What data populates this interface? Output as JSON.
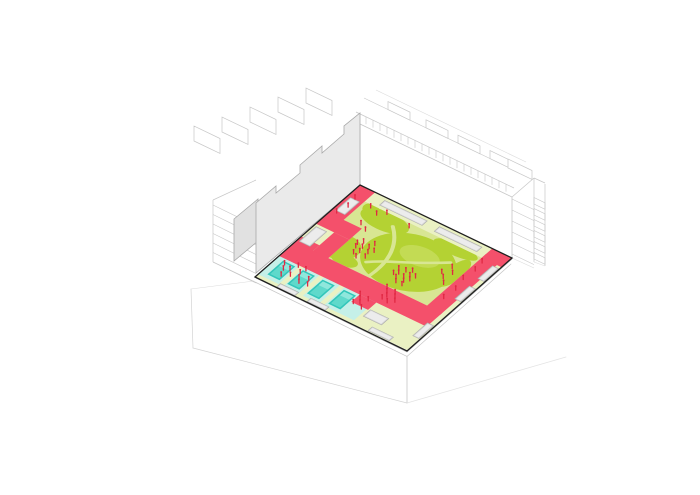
{
  "scene": {
    "kind": "axonometric-architecture-diagram",
    "elements": [
      "perimeter-buildings-wireframe",
      "section-cut-wall",
      "courtyard-landscape",
      "pool-deck",
      "people-markers"
    ]
  },
  "colors": {
    "background": "#FFFFFF",
    "outline_dark": "#1F1F1F",
    "wireframe": "#C7C7C7",
    "wireframe_faint": "#DCDCDC",
    "wall_face": "#EAEAEA",
    "wall_side": "#E1E1E1",
    "wall_stroke": "#A8A8A8",
    "facade_white": "#FFFFFF",
    "facade_stroke": "#C6C6C6",
    "border_pale": "#EAF1C3",
    "lawn_path": "#D8E693",
    "lawn_green": "#B4D233",
    "lawn_light": "#C5DD5A",
    "path_pink": "#F4506B",
    "water_deck": "#C5F0E8",
    "pool_rim": "#33C6BA",
    "pool_water": "#5FD9CB",
    "pool_shallow": "#8FE7DC",
    "planter_fill": "#D6D6D6",
    "planter_top": "#ECECEC",
    "planter_stroke": "#A9A9A9",
    "people_red": "#E02843",
    "ground_line": "#D3D3D3",
    "slab_edge": "#ABABAB"
  },
  "courtyard": {
    "corners_screen": {
      "north": [
        360,
        185
      ],
      "east": [
        512,
        258
      ],
      "south": [
        407,
        351
      ],
      "west": [
        255,
        277
      ]
    },
    "plan_matrix": [
      1.52,
      0.73,
      -1.05,
      0.92,
      360,
      185
    ],
    "pink_paths": [
      [
        0,
        0,
        10,
        32
      ],
      [
        0,
        30,
        22,
        12
      ],
      [
        12,
        42,
        10,
        22
      ],
      [
        0,
        56,
        12,
        21
      ],
      [
        0,
        62,
        97,
        15
      ],
      [
        53,
        77,
        11,
        8
      ],
      [
        87,
        6,
        10,
        58
      ],
      [
        87,
        0,
        13,
        10
      ]
    ],
    "lawn_polygon": "10,10 87,10 87,62 22,62 22,30 10,30",
    "mounds": [
      [
        58,
        38,
        27,
        24
      ],
      [
        22,
        50,
        11,
        11
      ],
      [
        28,
        17,
        15,
        8
      ],
      [
        16,
        13,
        4.5,
        4.5
      ],
      [
        72,
        13,
        14,
        5
      ],
      [
        83,
        30,
        5,
        14
      ],
      [
        30,
        58,
        8,
        5
      ]
    ],
    "mound_light": [
      60,
      30,
      12,
      8
    ],
    "lawn_trails": [
      "M 40,52 C 50,42 58,40 76,24",
      "M 34,18 C 44,28 50,42 48,60"
    ],
    "water_deck": [
      0,
      76,
      63,
      21
    ],
    "deck_strips": [
      [
        13.5,
        76,
        3,
        21
      ],
      [
        26.5,
        76,
        3,
        21
      ],
      [
        40,
        76,
        3,
        21
      ]
    ],
    "pools": [
      [
        4,
        79,
        8,
        15
      ],
      [
        17,
        79,
        8,
        15
      ],
      [
        30,
        79,
        8,
        15
      ],
      [
        44,
        79,
        8,
        15
      ]
    ],
    "planters": [
      [
        18,
        2.5,
        28,
        5
      ],
      [
        54,
        2.5,
        28,
        5
      ],
      [
        1.5,
        44,
        7,
        16
      ],
      [
        2,
        12,
        6,
        14
      ],
      [
        95.5,
        12,
        4,
        14
      ],
      [
        95.5,
        34,
        4,
        14
      ],
      [
        95.5,
        74,
        4,
        14
      ],
      [
        14,
        96,
        12,
        3.7
      ],
      [
        34,
        96,
        12,
        3.7
      ],
      [
        74,
        95.5,
        14,
        4
      ],
      [
        65,
        84,
        12,
        7
      ]
    ],
    "people": [
      [
        30,
        40
      ],
      [
        32,
        44
      ],
      [
        35,
        42
      ],
      [
        37,
        46
      ],
      [
        33,
        48
      ],
      [
        29,
        46
      ],
      [
        36,
        38
      ],
      [
        39,
        43
      ],
      [
        31,
        51
      ],
      [
        34,
        53
      ],
      [
        38,
        50
      ],
      [
        28,
        43
      ],
      [
        58,
        47
      ],
      [
        60,
        50
      ],
      [
        62,
        46
      ],
      [
        64,
        51
      ],
      [
        66,
        48
      ],
      [
        61,
        54
      ],
      [
        63,
        57
      ],
      [
        66,
        54
      ],
      [
        68,
        51
      ],
      [
        58,
        52
      ],
      [
        65,
        44
      ],
      [
        69,
        47
      ],
      [
        67,
        57
      ],
      [
        62,
        64
      ],
      [
        64,
        67
      ],
      [
        66,
        70
      ],
      [
        68,
        65
      ],
      [
        70,
        68
      ],
      [
        72,
        71
      ],
      [
        65,
        73
      ],
      [
        69,
        74
      ],
      [
        16,
        13
      ],
      [
        22,
        16
      ],
      [
        26,
        12
      ],
      [
        20,
        28
      ],
      [
        25,
        31
      ],
      [
        42,
        14
      ],
      [
        5,
        12
      ],
      [
        6,
        20
      ],
      [
        4,
        28
      ],
      [
        80,
        28
      ],
      [
        83,
        32
      ],
      [
        81,
        38
      ],
      [
        84,
        42
      ],
      [
        78,
        35
      ],
      [
        90,
        14
      ],
      [
        91,
        22
      ],
      [
        90,
        32
      ],
      [
        92,
        42
      ],
      [
        91,
        52
      ],
      [
        7,
        82
      ],
      [
        9,
        86
      ],
      [
        12,
        84
      ],
      [
        15,
        88
      ],
      [
        18,
        83
      ],
      [
        20,
        87
      ],
      [
        22,
        90
      ],
      [
        11,
        91
      ],
      [
        25,
        85
      ],
      [
        27,
        89
      ],
      [
        19,
        79
      ],
      [
        14,
        79
      ],
      [
        54,
        78
      ],
      [
        56,
        81
      ],
      [
        58,
        84
      ],
      [
        60,
        79
      ],
      [
        55,
        86
      ],
      [
        61,
        87
      ]
    ]
  },
  "buildings": {
    "northeast_slab": {
      "facade_points": "360,124 512,197 512,258 360,185",
      "balustrade_line": [
        356,
        112,
        514,
        188
      ],
      "roof_back_line": [
        364,
        98,
        520,
        173
      ],
      "roof_far_line": [
        376,
        90,
        526,
        162
      ],
      "roof_boxes_x": [
        388,
        426,
        458,
        490
      ]
    },
    "east_wing": {
      "roof_link": [
        512,
        197,
        534,
        178
      ],
      "inner_vertical": [
        534,
        178,
        534,
        262
      ],
      "outer_vertical": [
        545,
        184,
        545,
        266
      ],
      "roof_edge": [
        534,
        178,
        545,
        183
      ],
      "base_line1": [
        512,
        258,
        534,
        268
      ],
      "base_line2": [
        534,
        262,
        545,
        266
      ],
      "floors": 6
    },
    "northwest_wall": {
      "main_points": "360,113 360,185 256,273 256,203 276,186 276,193 300,173 300,165 322,146 322,153 344,134 344,126",
      "side_points": "234,219 258,199 258,241 234,261",
      "roof_boxes": [
        [
          194,
          141
        ],
        [
          222,
          132
        ],
        [
          250,
          122
        ],
        [
          278,
          112
        ],
        [
          306,
          103
        ]
      ],
      "low_wing_vertical": [
        213,
        200,
        213,
        262
      ],
      "low_wing_top": [
        213,
        200,
        256,
        180
      ],
      "low_wing_base": [
        213,
        262,
        257,
        283
      ],
      "floors": 7
    }
  },
  "ground": {
    "slab_edge_upper": "512,259 407,352 256,278",
    "slab_edge_lower": "511,264 407,356.5 256,282.5",
    "plinth_vertical": [
      407,
      356,
      407,
      403
    ],
    "plinth_left": [
      407,
      403,
      193,
      348
    ],
    "plinth_right": [
      407,
      403,
      566,
      357
    ],
    "ground_left_vertical": [
      191,
      289,
      193,
      348
    ],
    "ground_left_link": [
      191,
      289,
      254,
      281
    ]
  }
}
